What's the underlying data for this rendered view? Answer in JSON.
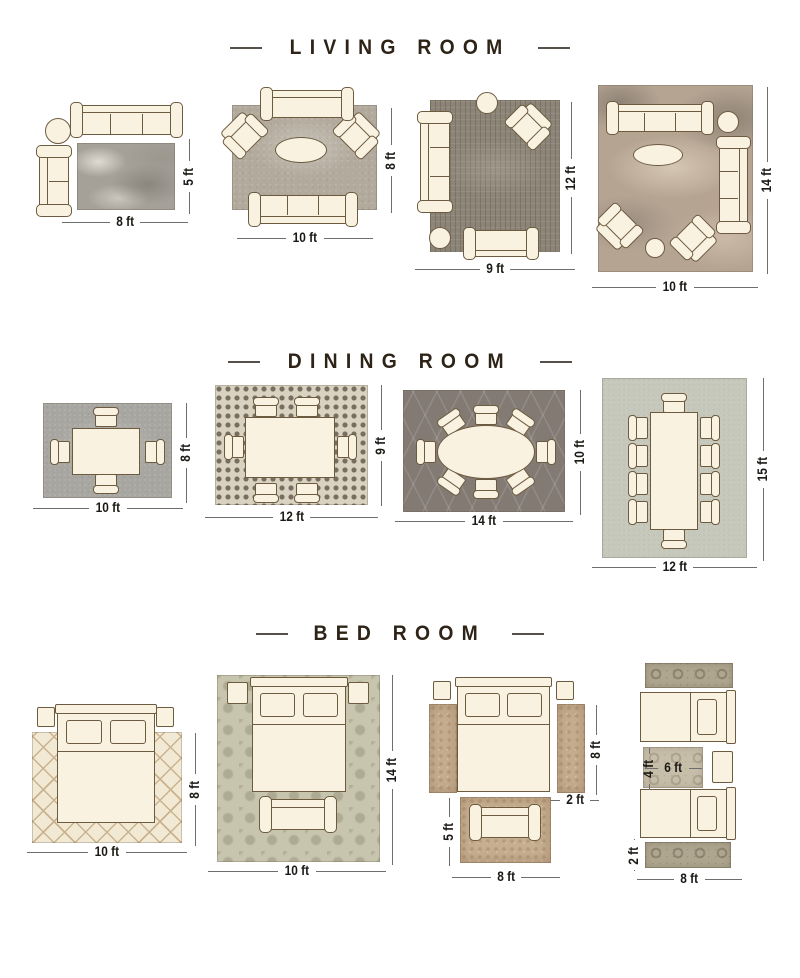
{
  "palette": {
    "background": "#ffffff",
    "title_color": "#2e2317",
    "dimension_text_color": "#1b1915",
    "dimension_line_color": "#6e6e6e",
    "furniture_fill": "#f9f2e1",
    "furniture_outline": "#6d5b40"
  },
  "sections": [
    {
      "title": "LIVING ROOM",
      "layouts": [
        {
          "width": "8 ft",
          "height": "5 ft"
        },
        {
          "width": "10 ft",
          "height": "8 ft"
        },
        {
          "width": "9 ft",
          "height": "12 ft"
        },
        {
          "width": "10 ft",
          "height": "14 ft"
        }
      ]
    },
    {
      "title": "DINING ROOM",
      "layouts": [
        {
          "width": "10 ft",
          "height": "8 ft"
        },
        {
          "width": "12 ft",
          "height": "9 ft"
        },
        {
          "width": "14 ft",
          "height": "10 ft"
        },
        {
          "width": "12 ft",
          "height": "15 ft"
        }
      ]
    },
    {
      "title": "BED ROOM",
      "layouts": [
        {
          "width": "10 ft",
          "height": "8 ft"
        },
        {
          "width": "10 ft",
          "height": "14 ft"
        },
        {
          "side_runner_length": "8 ft",
          "side_runner_width": "2 ft",
          "foot_rug_height": "5 ft",
          "foot_rug_width": "8 ft"
        },
        {
          "middle_rug_height": "4 ft",
          "middle_rug_width": "6 ft",
          "runner_width": "2 ft",
          "runner_length": "8 ft"
        }
      ]
    }
  ]
}
